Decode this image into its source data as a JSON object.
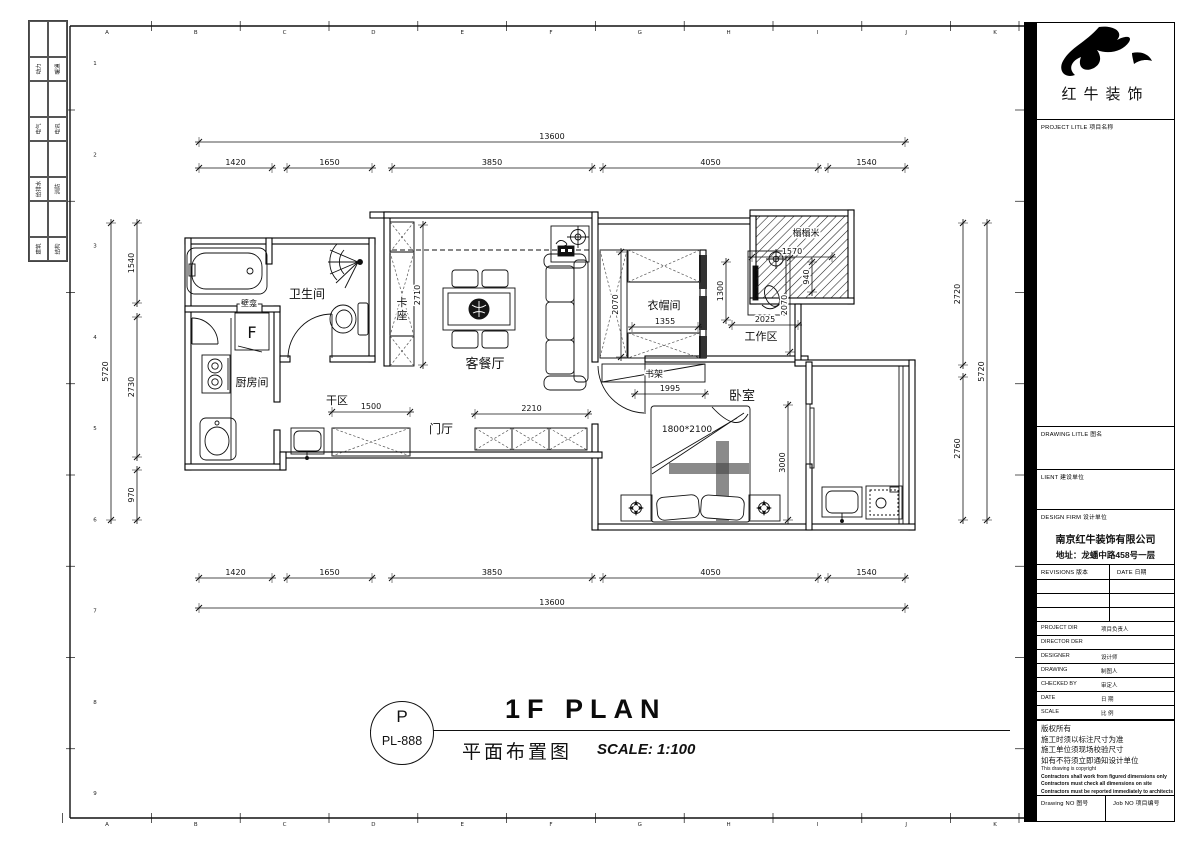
{
  "sheet": {
    "rulers": {
      "columns": [
        "A",
        "B",
        "C",
        "D",
        "E",
        "F",
        "G",
        "H",
        "I",
        "J",
        "K"
      ],
      "rows": [
        "1",
        "2",
        "3",
        "4",
        "5",
        "6",
        "7",
        "8",
        "9"
      ]
    },
    "discipline_strip": [
      {
        "left": "动力",
        "right": "暖通"
      },
      {
        "left": "电气",
        "right": "电讯"
      },
      {
        "left": "给排水",
        "right": "消防"
      },
      {
        "left": "建筑",
        "right": "结构"
      }
    ]
  },
  "plan": {
    "rooms": {
      "bathroom": "卫生间",
      "niche": "壁龛",
      "booth": "卡座",
      "living_dining": "客餐厅",
      "kitchen": "厨房间",
      "dry_area": "干区",
      "foyer": "门厅",
      "cloakroom": "衣帽间",
      "workzone": "工作区",
      "tatami": "榻榻米",
      "bookshelf": "书架",
      "bedroom": "卧室",
      "fridge": "F",
      "bed_size": "1800*2100"
    },
    "dimensions": {
      "top_total": "13600",
      "top_segments": [
        "1420",
        "1650",
        "3850",
        "4050",
        "1540"
      ],
      "bottom_total": "13600",
      "bottom_segments": [
        "1420",
        "1650",
        "3850",
        "4050",
        "1540"
      ],
      "left_total": "5720",
      "left_segments": [
        "1540",
        "2730",
        "970"
      ],
      "right_total": "5720",
      "right_segments": [
        "2720",
        "2760"
      ],
      "inner": {
        "booth_h": "2710",
        "foyer_cab": "2210",
        "dry_cab": "1500",
        "cloak_w": "1355",
        "cloak_h": "2070",
        "desk": "1300",
        "tatami_w": "1570",
        "tatami_h": "940",
        "work_h": "2070",
        "work_w": "2025",
        "shelf": "1995",
        "bedroom_h": "3000"
      }
    }
  },
  "title_bar": {
    "code_letter": "P",
    "code": "PL-888",
    "title": "1F PLAN",
    "subtitle": "平面布置图",
    "scale": "SCALE: 1:100"
  },
  "title_block": {
    "brand": "红牛装饰",
    "project_title": "PROJECT LITLE  项目名称",
    "drawing_title": "DRAWING LITLE  图名",
    "client": "LIENT  建设单位",
    "design_firm": "DESIGN FIRM  设计单位",
    "company": "南京红牛装饰有限公司",
    "address": "地址：龙蟠中路458号一层",
    "revisions": "REVISIONS  版本",
    "date_col": "DATE  日期",
    "rows": [
      {
        "en": "PROJECT DIR",
        "cn": "项目负责人"
      },
      {
        "en": "DIRECTOR DER",
        "cn": ""
      },
      {
        "en": "DESIGNER",
        "cn": "设计师"
      },
      {
        "en": "DRAWING",
        "cn": "制图人"
      },
      {
        "en": "CHECKED BY",
        "cn": "审定人"
      },
      {
        "en": "DATE",
        "cn": "日  期"
      },
      {
        "en": "SCALE",
        "cn": "比  例"
      }
    ],
    "notes_cn": [
      "版权所有",
      "施工时须以标注尺寸为准",
      "施工单位须现场校验尺寸",
      "如有不符须立即通知设计单位"
    ],
    "notes_en": [
      "This drawing is copyright",
      "Contractors shall work from figured dimensions only",
      "Contractors must check all dimensions on site",
      "Contractors must be reported immediately to architects"
    ],
    "drawing_no": "Drawing NO  图号",
    "job_no": "Job NO  项目编号",
    "colors": {
      "line": "#000000",
      "band": "#000000"
    }
  }
}
